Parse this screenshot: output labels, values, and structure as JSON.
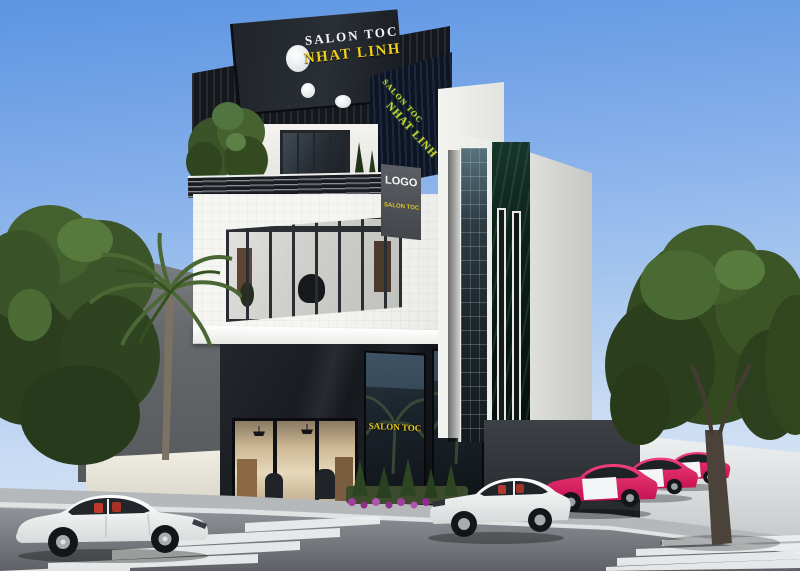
{
  "image": {
    "type": "3D exterior architectural rendering",
    "subject": "Modern four-storey hair salon building with black-and-white facade, parked cars, palm trees and zebra crossings on a sunny street corner"
  },
  "signs": {
    "top_sign": {
      "line1": "SALON TOC",
      "line2": "NHAT LINH"
    },
    "side_sign": {
      "line1": "SALON TOC",
      "line2": "NHAT LINH"
    },
    "logo_sign": {
      "line1": "LOGO",
      "line2": "SALON TOC"
    },
    "storefront": {
      "left": "SALON TOC",
      "right": "NHAT LINH"
    }
  },
  "palette": {
    "sky_blue": "#6ea2e6",
    "facade_black": "#15181c",
    "sign_yellow": "#f0d01c",
    "wall_white": "#f2f2ef",
    "marble_green": "#0c201a",
    "pink_car": "#e0215f",
    "asphalt": "#7c8084",
    "foliage": "#33491f"
  }
}
